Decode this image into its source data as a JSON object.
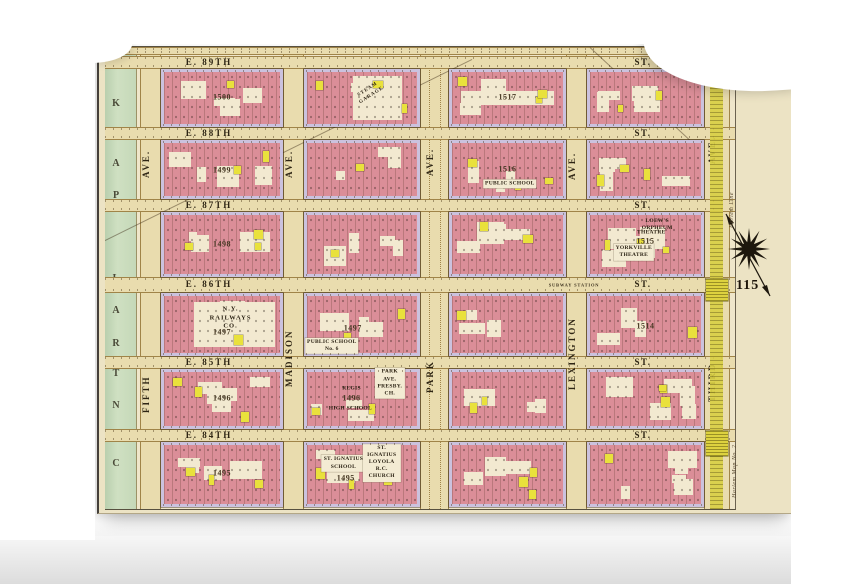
{
  "plate_number": "115",
  "park_label": "CENTRAL PARK",
  "subway_label": "SUBWAY STATION",
  "streets": [
    {
      "id": "s90",
      "left": "",
      "right": "",
      "clipped": true
    },
    {
      "id": "s89",
      "left": "E. 89TH",
      "right": "ST."
    },
    {
      "id": "s88",
      "left": "E. 88TH",
      "right": "ST."
    },
    {
      "id": "s87",
      "left": "E. 87TH",
      "right": "ST."
    },
    {
      "id": "s86",
      "left": "E. 86TH",
      "right": "ST.",
      "extra": "SUBWAY STATION"
    },
    {
      "id": "s85",
      "left": "E. 85TH",
      "right": "ST."
    },
    {
      "id": "s84",
      "left": "E. 84TH",
      "right": "ST."
    }
  ],
  "avenues": [
    {
      "id": "fifth",
      "top": "AVE.",
      "name": "FIFTH"
    },
    {
      "id": "madison",
      "top": "AVE.",
      "name": "MADISON"
    },
    {
      "id": "park",
      "top": "AVE.",
      "name": "PARK"
    },
    {
      "id": "lexington",
      "top": "AVE.",
      "name": "LEXINGTON"
    },
    {
      "id": "third",
      "top": "AVE.",
      "name": "THIRD"
    }
  ],
  "blocks": [
    {
      "col": 0,
      "row": 0,
      "number": "1500"
    },
    {
      "col": 0,
      "row": 1,
      "number": "1499"
    },
    {
      "col": 0,
      "row": 2,
      "number": "1498"
    },
    {
      "col": 0,
      "row": 3,
      "number": "1497",
      "special": "railways",
      "pois": [
        {
          "id": "railways",
          "label": "N.Y. RAILWAYS CO."
        }
      ]
    },
    {
      "col": 0,
      "row": 4,
      "number": "1496"
    },
    {
      "col": 0,
      "row": 5,
      "number": "1495"
    },
    {
      "col": 1,
      "row": 0,
      "number": "",
      "special": "garage",
      "pois": [
        {
          "id": "garage",
          "label": "STEAM GARAGE"
        }
      ]
    },
    {
      "col": 1,
      "row": 1,
      "number": ""
    },
    {
      "col": 1,
      "row": 2,
      "number": ""
    },
    {
      "col": 1,
      "row": 3,
      "number": "1497",
      "pois": [
        {
          "id": "ps6",
          "label": "PUBLIC SCHOOL\nNo. 6"
        }
      ]
    },
    {
      "col": 1,
      "row": 4,
      "number": "1496",
      "pois": [
        {
          "id": "regis",
          "label": "REGIS"
        },
        {
          "id": "regis2",
          "label": "HIGH SCHOOL"
        },
        {
          "id": "presby",
          "label": "PARK AVE.\nPRESBY. CH."
        }
      ]
    },
    {
      "col": 1,
      "row": 5,
      "number": "1495",
      "pois": [
        {
          "id": "ign_school",
          "label": "ST. IGNATIUS\nSCHOOL"
        },
        {
          "id": "ign_church",
          "label": "ST. IGNATIUS LOYOLA\nR.C. CHURCH"
        }
      ]
    },
    {
      "col": 2,
      "row": 0,
      "number": "1517",
      "special": "rowband"
    },
    {
      "col": 2,
      "row": 1,
      "number": "1516",
      "pois": [
        {
          "id": "ps_lex",
          "label": "PUBLIC SCHOOL"
        }
      ]
    },
    {
      "col": 2,
      "row": 2,
      "number": ""
    },
    {
      "col": 2,
      "row": 3,
      "number": ""
    },
    {
      "col": 2,
      "row": 4,
      "number": ""
    },
    {
      "col": 2,
      "row": 5,
      "number": ""
    },
    {
      "col": 3,
      "row": 0,
      "number": ""
    },
    {
      "col": 3,
      "row": 1,
      "number": ""
    },
    {
      "col": 3,
      "row": 2,
      "number": "1515",
      "pois": [
        {
          "id": "orpheum",
          "label": "LOEW'S ORPHEUM"
        },
        {
          "id": "orpheum2",
          "label": "THEATRE"
        },
        {
          "id": "yorkville",
          "label": "YORKVILLE\nTHEATRE"
        }
      ]
    },
    {
      "col": 3,
      "row": 3,
      "number": "1514"
    },
    {
      "col": 3,
      "row": 4,
      "number": ""
    },
    {
      "col": 3,
      "row": 5,
      "number": ""
    }
  ],
  "margin_notes": [
    {
      "id": "note-top",
      "text": "Harlem Line"
    },
    {
      "id": "note-bottom",
      "text": "Harlem Map No. 2"
    }
  ],
  "colors": {
    "sheet_cream": "#ece3c4",
    "block_pink": "#db8e98",
    "block_edge": "#cbc2de",
    "court_cream": "#f2e9d0",
    "frame_yellow": "#e9e13c",
    "park_green": "#cfe0c2",
    "road_tan": "#e9dcae",
    "el_yellow": "#d9cf44",
    "ink": "#2e2514"
  }
}
